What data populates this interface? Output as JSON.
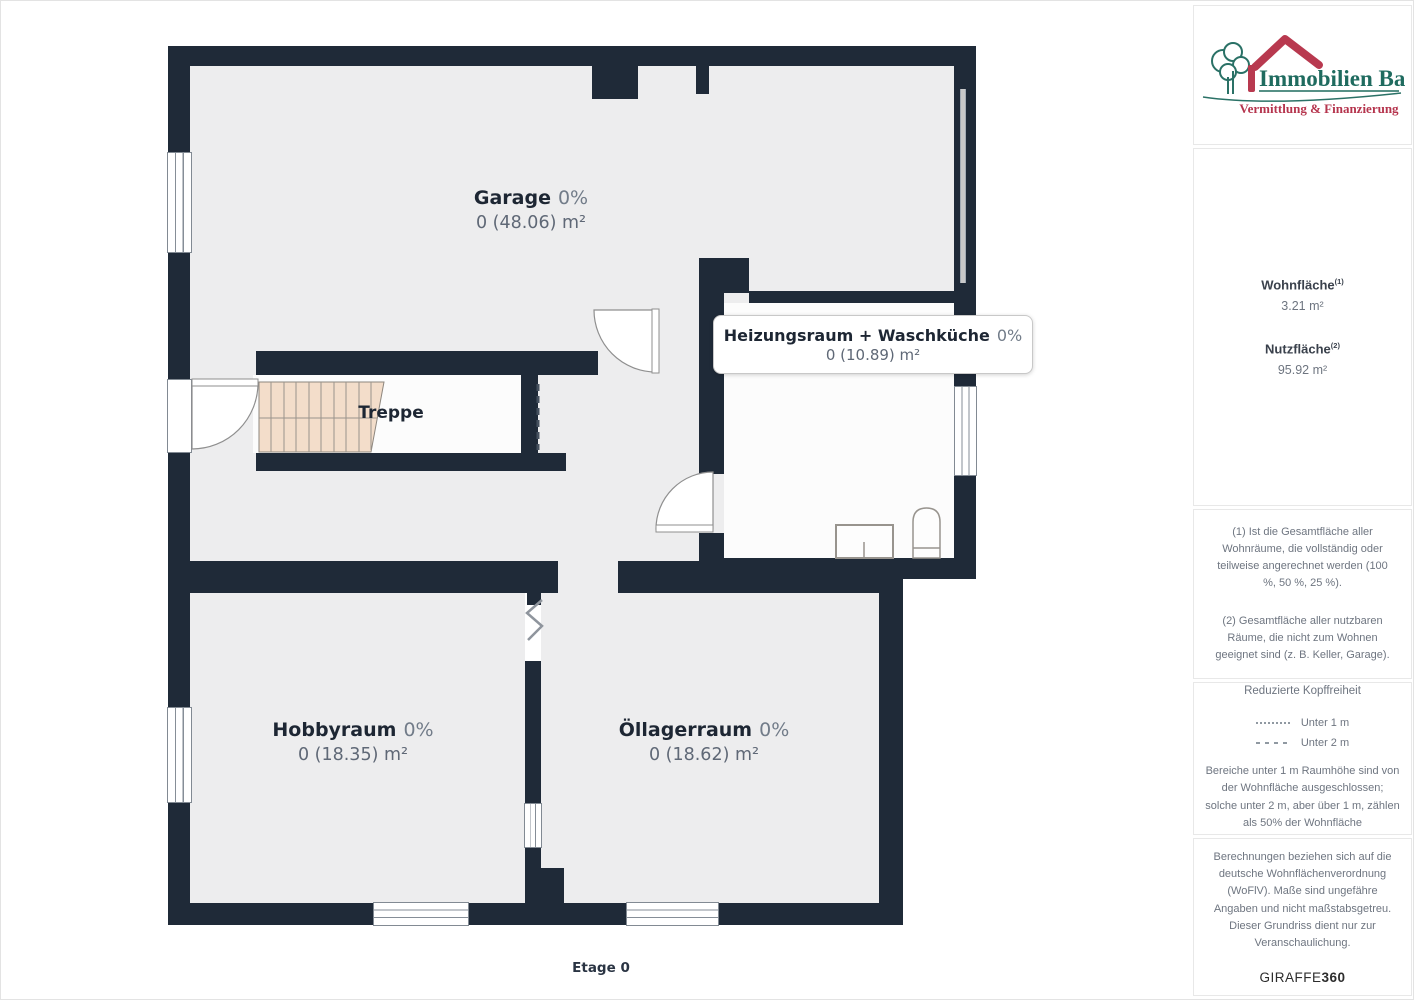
{
  "plan": {
    "rooms": [
      {
        "name": "Garage",
        "percent": "0%",
        "area": "0 (48.06) m²"
      },
      {
        "name": "Heizungsraum + Waschküche",
        "percent": "0%",
        "area": "0 (10.89) m²"
      },
      {
        "name": "Treppe"
      },
      {
        "name": "Hobbyraum",
        "percent": "0%",
        "area": "0 (18.35) m²"
      },
      {
        "name": "Öllagerraum",
        "percent": "0%",
        "area": "0 (18.62) m²"
      }
    ],
    "floor_label": "Etage 0",
    "colors": {
      "wall": "#1f2a38",
      "floor": "#ededee",
      "room_light": "#fcfcfc",
      "stairs": "#f3ddca"
    }
  },
  "sidebar": {
    "logo": {
      "title": "Immobilien Bart",
      "subtitle": "Vermittlung & Finanzierung",
      "teal": "#1f6b5f",
      "red": "#b5344d"
    },
    "areas": {
      "wohnflaeche_label": "Wohnfläche",
      "wohnflaeche_sup": "(1)",
      "wohnflaeche_value": "3.21 m²",
      "nutzflaeche_label": "Nutzfläche",
      "nutzflaeche_sup": "(2)",
      "nutzflaeche_value": "95.92 m²"
    },
    "notes": {
      "note1": "(1) Ist die Gesamtfläche aller Wohnräume, die vollständig oder teilweise angerechnet werden (100 %, 50 %, 25 %).",
      "note2": "(2) Gesamtfläche aller nutzbaren Räume, die nicht zum Wohnen geeignet sind (z. B. Keller, Garage)."
    },
    "legend": {
      "title": "Reduzierte Kopffreiheit",
      "item1": "Unter 1 m",
      "item2": "Unter 2 m",
      "text": "Bereiche unter 1 m Raumhöhe sind von der Wohnfläche ausgeschlossen; solche unter 2 m, aber über 1 m, zählen als 50% der Wohnfläche"
    },
    "disclaimer": {
      "text": "Berechnungen beziehen sich auf die deutsche Wohnflächenverordnung (WoFlV). Maße sind ungefähre Angaben und nicht maßstabsgetreu. Dieser Grundriss dient nur zur Veranschaulichung.",
      "brand_regular": "GIRAFFE",
      "brand_bold": "360"
    }
  }
}
